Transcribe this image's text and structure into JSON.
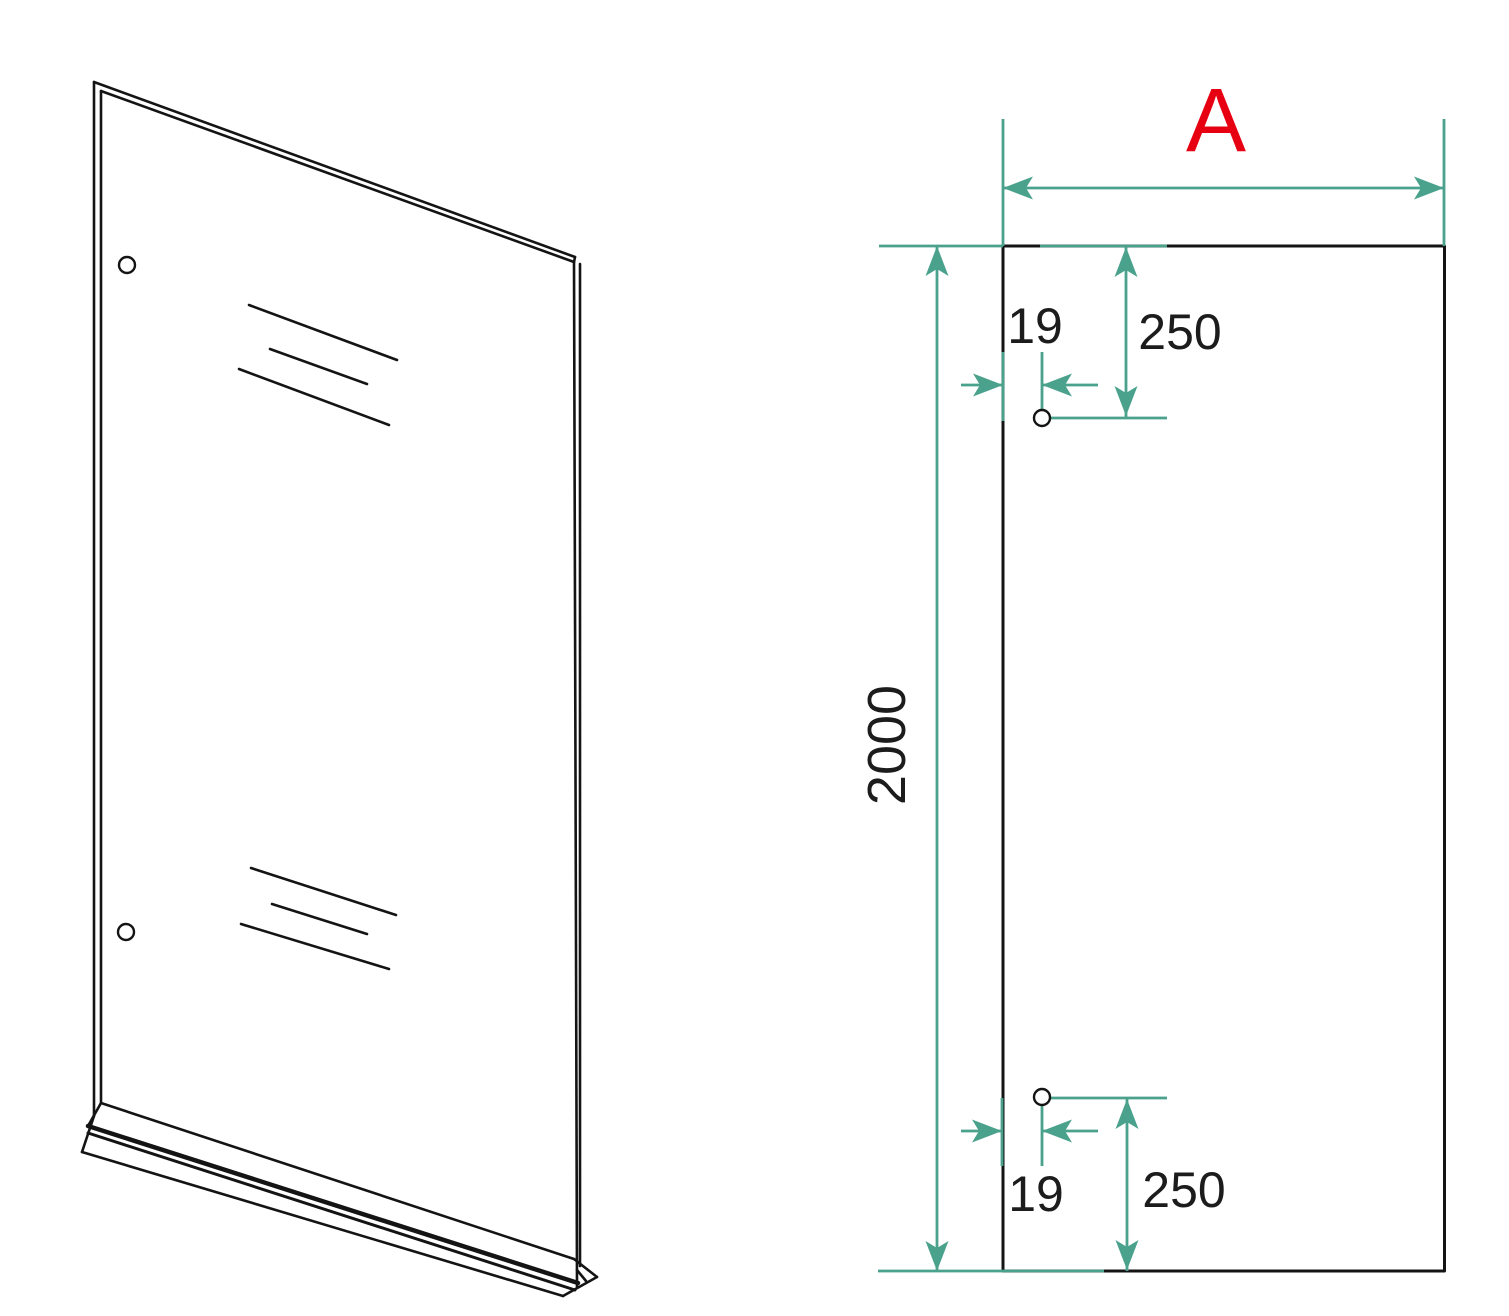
{
  "drawing": {
    "labels": {
      "width": "A",
      "height": "2000",
      "top_hole": {
        "offset_x": "19",
        "offset_y": "250"
      },
      "bottom_hole": {
        "offset_x": "19",
        "offset_y": "250"
      }
    },
    "colors": {
      "dimension": "#4aa28d",
      "outline": "#141414",
      "accent": "#e60012"
    }
  }
}
